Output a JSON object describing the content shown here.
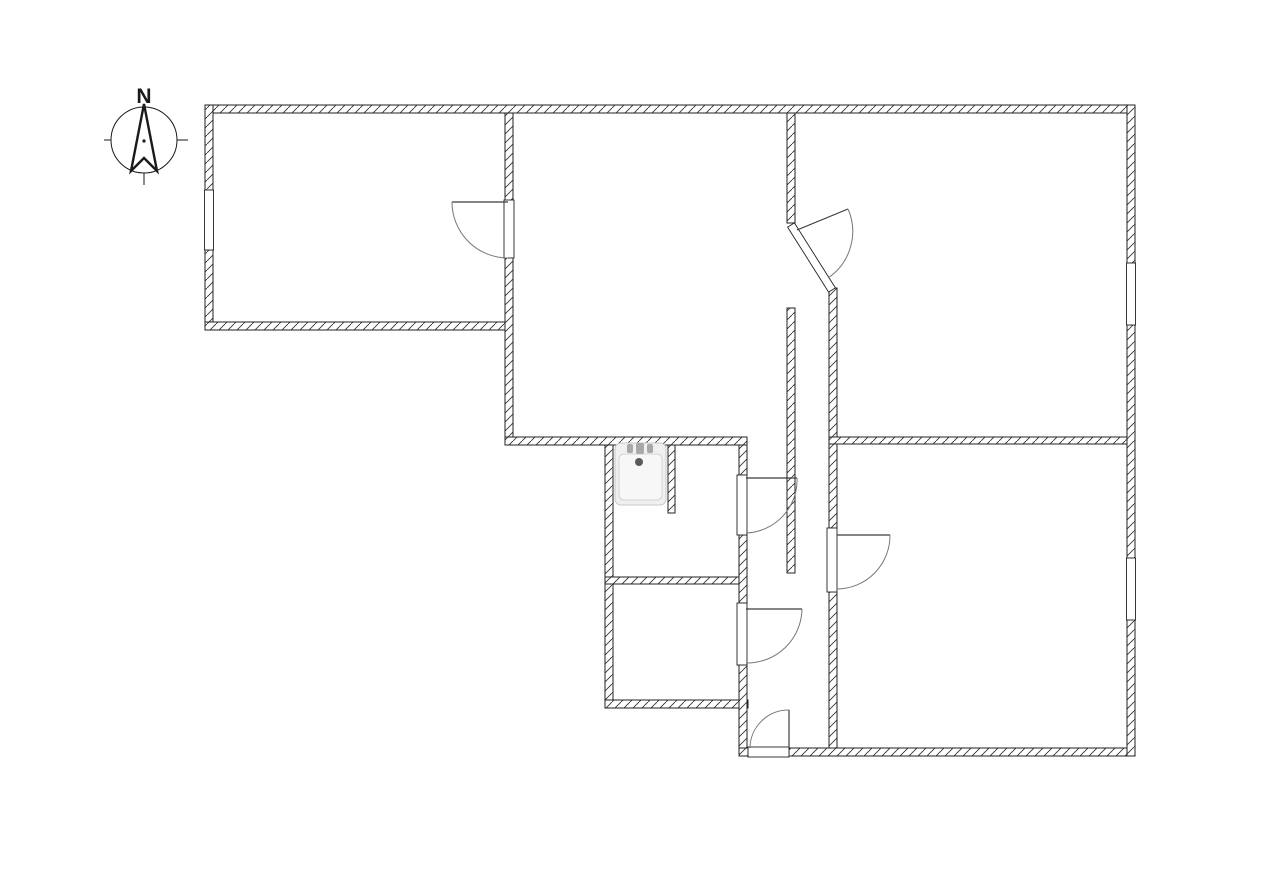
{
  "meta": {
    "canvas": {
      "width": 1280,
      "height": 888
    },
    "colors": {
      "background": "#ffffff",
      "wall_outline": "#222222",
      "hatch_line": "#333333",
      "door_leaf": "#3a3a3a",
      "door_arc": "#777777",
      "fixture_fill": "#f0f0f0",
      "fixture_edge": "#c8c8c8",
      "compass_line": "#1a1a1a"
    }
  },
  "compass": {
    "label": "N",
    "cx": 144,
    "cy": 140,
    "r": 33,
    "needle_points": "144,104 157,171 144,158 131,171",
    "ticks": [
      [
        104,
        140,
        111,
        140
      ],
      [
        177,
        140,
        188,
        140
      ],
      [
        144,
        173,
        144,
        185
      ]
    ],
    "dot": {
      "cx": 144,
      "cy": 141,
      "r": 1.6
    },
    "label_x": 144,
    "label_y": 103,
    "label_size": 21
  },
  "floorplan": {
    "wall_thickness": 8,
    "walls": [
      {
        "name": "wall-top",
        "x": 205,
        "y": 105,
        "w": 930,
        "h": 8
      },
      {
        "name": "wall-left-above-window",
        "x": 205,
        "y": 105,
        "w": 8,
        "h": 85
      },
      {
        "name": "wall-left-below-window",
        "x": 205,
        "y": 250,
        "w": 8,
        "h": 80
      },
      {
        "name": "wall-topleft-room-bottom",
        "x": 205,
        "y": 322,
        "w": 308,
        "h": 8
      },
      {
        "name": "wall-topleft-middle-divider",
        "x": 505,
        "y": 113,
        "w": 8,
        "h": 332
      },
      {
        "name": "wall-middle-room-bottom",
        "x": 505,
        "y": 437,
        "w": 242,
        "h": 8
      },
      {
        "name": "wall-bath-west",
        "x": 605,
        "y": 445,
        "w": 8,
        "h": 263
      },
      {
        "name": "wall-bath-wc-divider",
        "x": 605,
        "y": 577,
        "w": 142,
        "h": 7
      },
      {
        "name": "wall-wc-bottom",
        "x": 605,
        "y": 700,
        "w": 143,
        "h": 8
      },
      {
        "name": "wall-bath-east-upper",
        "x": 739,
        "y": 445,
        "w": 8,
        "h": 30
      },
      {
        "name": "wall-bath-east-middle",
        "x": 739,
        "y": 535,
        "w": 8,
        "h": 68
      },
      {
        "name": "wall-bath-east-lower",
        "x": 739,
        "y": 665,
        "w": 8,
        "h": 83
      },
      {
        "name": "wall-bottom-left-stub",
        "x": 739,
        "y": 748,
        "w": 9,
        "h": 8
      },
      {
        "name": "wall-bottom",
        "x": 789,
        "y": 748,
        "w": 346,
        "h": 8
      },
      {
        "name": "wall-hall-spine",
        "x": 787,
        "y": 308,
        "w": 8,
        "h": 265
      },
      {
        "name": "wall-middle-topright-divider",
        "x": 787,
        "y": 113,
        "w": 8,
        "h": 110
      },
      {
        "name": "wall-east-upper",
        "x": 829,
        "y": 288,
        "w": 8,
        "h": 240
      },
      {
        "name": "wall-east-lower",
        "x": 829,
        "y": 592,
        "w": 8,
        "h": 156
      },
      {
        "name": "wall-right-rooms-divider",
        "x": 829,
        "y": 437,
        "w": 301,
        "h": 7
      },
      {
        "name": "wall-right-above-window1",
        "x": 1127,
        "y": 105,
        "w": 8,
        "h": 158
      },
      {
        "name": "wall-right-between-windows",
        "x": 1127,
        "y": 325,
        "w": 8,
        "h": 233
      },
      {
        "name": "wall-right-below-window2",
        "x": 1127,
        "y": 620,
        "w": 8,
        "h": 136
      }
    ],
    "chamfer_gap": {
      "name": "door-gap-topright-chamfer",
      "points": "787.6,227.1 794.4,222.9 835.4,287.9 828.6,292.1"
    },
    "windows": [
      {
        "name": "window-left",
        "x": 204.5,
        "y": 190,
        "w": 9,
        "h": 60
      },
      {
        "name": "window-right-top",
        "x": 1126.5,
        "y": 263,
        "w": 9,
        "h": 62
      },
      {
        "name": "window-right-bottom",
        "x": 1126.5,
        "y": 558,
        "w": 9,
        "h": 62
      }
    ],
    "door_gaps": [
      {
        "name": "door-gap-topleft-room",
        "x": 504,
        "y": 200,
        "w": 10,
        "h": 58
      },
      {
        "name": "door-gap-bathroom",
        "x": 737,
        "y": 475,
        "w": 10,
        "h": 60
      },
      {
        "name": "door-gap-wc",
        "x": 737,
        "y": 603,
        "w": 10,
        "h": 62
      },
      {
        "name": "door-gap-bottomright-room",
        "x": 827,
        "y": 528,
        "w": 10,
        "h": 64
      },
      {
        "name": "door-gap-entrance",
        "x": 748,
        "y": 747,
        "w": 41,
        "h": 10
      }
    ],
    "doors": [
      {
        "name": "door-topleft-room",
        "hinge": [
          508,
          202
        ],
        "tip": [
          452,
          202
        ],
        "end": [
          508,
          258
        ]
      },
      {
        "name": "door-topright-room",
        "hinge": [
          797,
          230
        ],
        "tip": [
          848,
          209
        ],
        "end": [
          828,
          278
        ]
      },
      {
        "name": "door-bathroom",
        "hinge": [
          746,
          478
        ],
        "tip": [
          797,
          478
        ],
        "end": [
          746,
          533
        ]
      },
      {
        "name": "door-bottomright-room",
        "hinge": [
          837,
          535
        ],
        "tip": [
          890,
          535
        ],
        "end": [
          837,
          589
        ]
      },
      {
        "name": "door-wc",
        "hinge": [
          746,
          609
        ],
        "tip": [
          802,
          609
        ],
        "end": [
          746,
          663
        ]
      },
      {
        "name": "door-entrance",
        "hinge": [
          789,
          748
        ],
        "tip": [
          789,
          710
        ],
        "end": [
          750,
          748
        ]
      }
    ],
    "sink": {
      "outer": {
        "x": 615,
        "y": 443,
        "w": 51,
        "h": 62,
        "rx": 6
      },
      "basin": {
        "x": 619,
        "y": 454,
        "w": 43,
        "h": 46,
        "rx": 5
      },
      "drain": {
        "cx": 639,
        "cy": 462,
        "r": 4
      },
      "faucet_parts": [
        {
          "x": 627,
          "y": 444,
          "w": 6,
          "h": 9
        },
        {
          "x": 636,
          "y": 443,
          "w": 8,
          "h": 11
        },
        {
          "x": 647,
          "y": 444,
          "w": 6,
          "h": 9
        }
      ],
      "stub_wall": {
        "name": "wall-sink-niche-stub",
        "x": 668,
        "y": 445,
        "w": 7,
        "h": 68
      }
    }
  }
}
